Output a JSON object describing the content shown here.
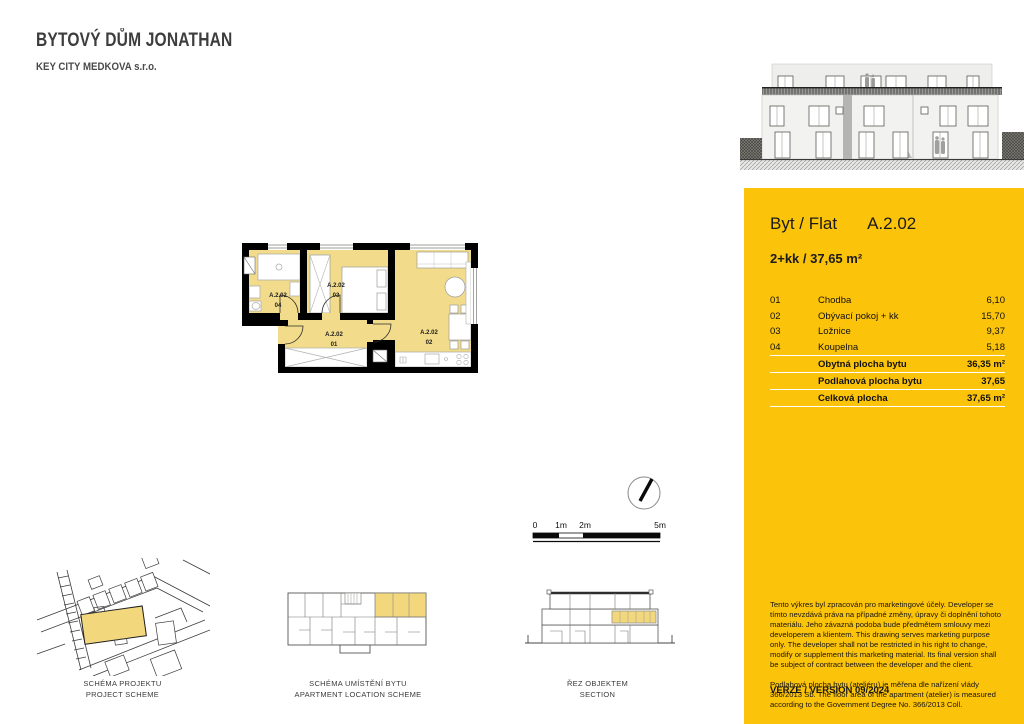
{
  "document": {
    "title": "BYTOVÝ DŮM JONATHAN",
    "subtitle": "KEY CITY MEDKOVA s.r.o."
  },
  "unit_panel": {
    "accent_color": "#fcc30b",
    "flat_label": "Byt / Flat",
    "flat_id": "A.2.02",
    "disposition": "2+kk / 37,65 m²",
    "rooms": [
      {
        "num": "01",
        "name": "Chodba",
        "area": "6,10"
      },
      {
        "num": "02",
        "name": "Obývací pokoj + kk",
        "area": "15,70"
      },
      {
        "num": "03",
        "name": "Ložnice",
        "area": "9,37"
      },
      {
        "num": "04",
        "name": "Koupelna",
        "area": "5,18"
      }
    ],
    "summary": [
      {
        "label": "Obytná plocha bytu",
        "value": "36,35 m²"
      },
      {
        "label": "Podlahová plocha bytu",
        "value": "37,65"
      },
      {
        "label": "Celková plocha",
        "value": "37,65 m²"
      }
    ],
    "disclaimer": "Tento výkres byl zpracován pro marketingové účely. Developer se tímto nevzdává práva na případné změny, úpravy či doplnění tohoto materiálu. Jeho závazná podoba bude předmětem smlouvy mezi developerem a klientem. This drawing serves marketing purpose only. The developer shall not be restricted in his right to change, modify or supplement this marketing material. Its final version shall be subject of contract between the developer and the client.",
    "measurement_note": "Podlahová plocha bytu (ateliéru) je měřena dle nařízení vlády 366/2013 Sb. The floor area of the apartment (atelier) is measured according to the Government Degree No. 366/2013 Coll.",
    "version": "VERZE / VERSION 09/2024"
  },
  "floor_plan": {
    "room_fill_color": "#f2dc8b",
    "labels": [
      {
        "id": "A.2.02",
        "num": "01"
      },
      {
        "id": "A.2.02",
        "num": "02"
      },
      {
        "id": "A.2.02",
        "num": "03"
      },
      {
        "id": "A.2.02",
        "num": "04"
      }
    ]
  },
  "scale_bar": {
    "ticks": [
      "0",
      "1m",
      "2m",
      "5m"
    ]
  },
  "schemes": {
    "highlight_color": "#f2d77d",
    "project": {
      "caption_cz": "SCHÉMA PROJEKTU",
      "caption_en": "PROJECT SCHEME"
    },
    "location": {
      "caption_cz": "SCHÉMA UMÍSTĚNÍ BYTU",
      "caption_en": "APARTMENT LOCATION SCHEME"
    },
    "section": {
      "caption_cz": "ŘEZ OBJEKTEM",
      "caption_en": "SECTION"
    }
  }
}
